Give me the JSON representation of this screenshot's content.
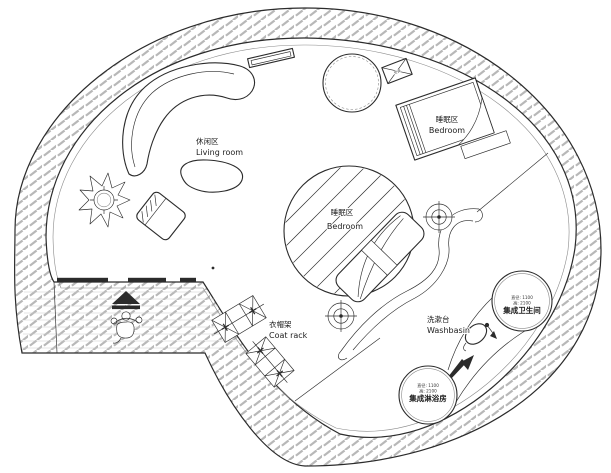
{
  "labels": {
    "living_room": {
      "zh": "休闲区",
      "en": "Living room"
    },
    "bedroom_upper": {
      "zh": "睡眠区",
      "en": "Bedroom"
    },
    "bedroom_center": {
      "zh": "睡眠区",
      "en": "Bedroom"
    },
    "coat_rack": {
      "zh": "衣帽架",
      "en": "Coat rack"
    },
    "washbasin": {
      "zh": "洗漱台",
      "en": "Washbasin"
    },
    "bathroom_pod": {
      "name": "集成卫生间",
      "spec1": "直径: 1100",
      "spec2": "高: 2100"
    },
    "shower_pod": {
      "name": "集成淋浴房",
      "spec1": "直径: 1100",
      "spec2": "高: 2100"
    },
    "ac_unit": {
      "name": "空调"
    }
  },
  "colors": {
    "line": "#2b2b2b",
    "light_line": "#8a8a8a",
    "hatch": "#b8b8b8",
    "background": "#ffffff"
  }
}
